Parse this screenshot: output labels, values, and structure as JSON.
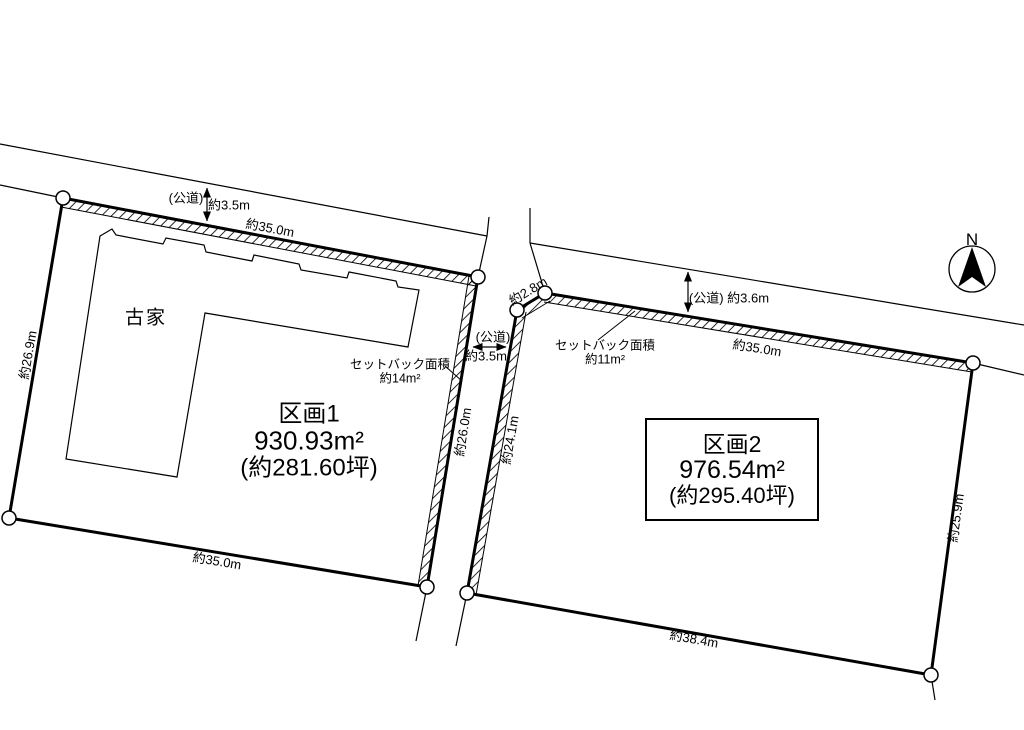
{
  "compass": {
    "north_label": "N"
  },
  "roads": {
    "left": {
      "type_label": "(公道)",
      "width_label": "約3.5m"
    },
    "middle": {
      "type_label": "(公道)",
      "width_label": "約3.5m"
    },
    "right": {
      "combined_label": "(公道) 約3.6m"
    }
  },
  "plot1": {
    "name": "区画1",
    "area_sqm": "930.93m²",
    "area_tsubo": "(約281.60坪)",
    "building_label": "古家",
    "setback_title": "セットバック面積",
    "setback_area": "約14m²",
    "dim_top": "約35.0m",
    "dim_left": "約26.9m",
    "dim_right": "約26.0m",
    "dim_bottom": "約35.0m"
  },
  "plot2": {
    "name": "区画2",
    "area_sqm": "976.54m²",
    "area_tsubo": "(約295.40坪)",
    "setback_title": "セットバック面積",
    "setback_area": "約11m²",
    "dim_top": "約35.0m",
    "dim_chamfer": "約2.8m",
    "dim_left": "約24.1m",
    "dim_right": "約25.9m",
    "dim_bottom": "約38.4m"
  }
}
